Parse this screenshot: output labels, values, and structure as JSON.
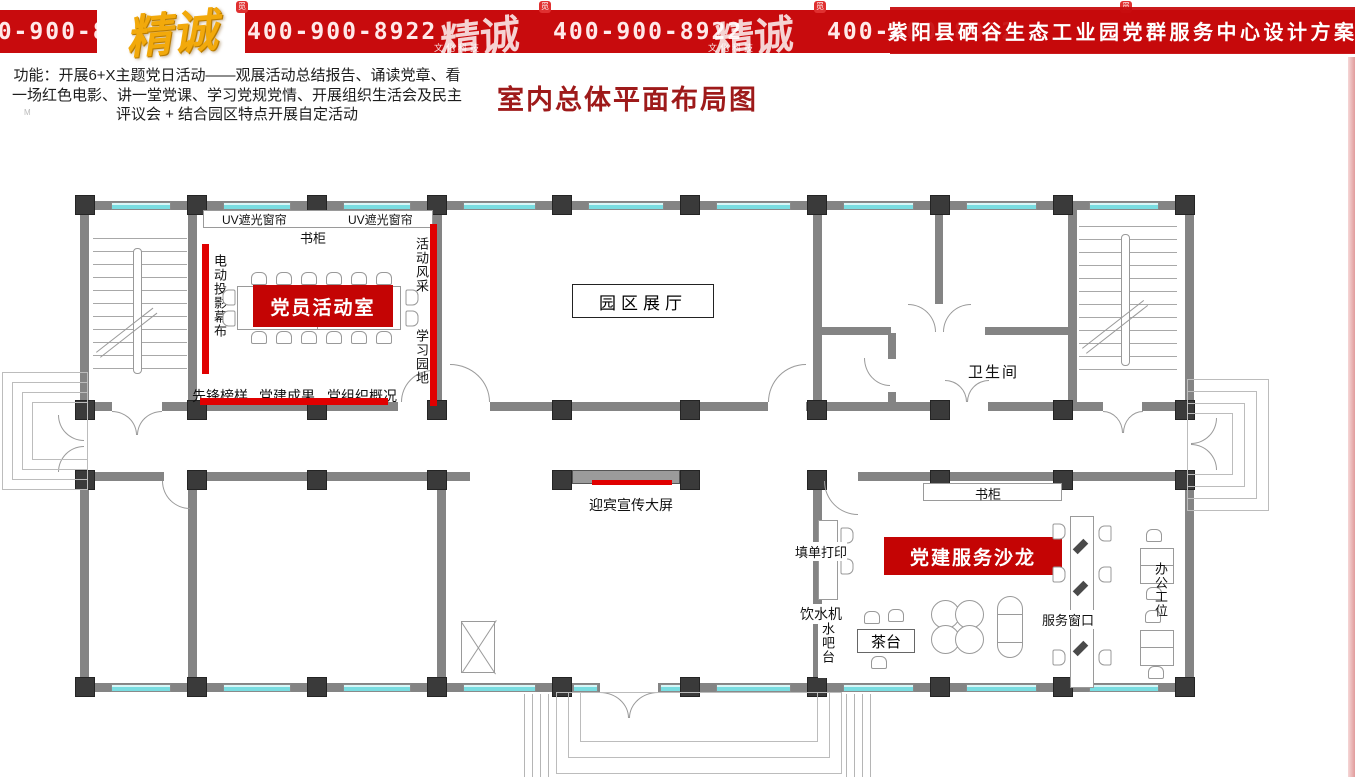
{
  "banner": {
    "phone": "400-900-8922",
    "brand": "精诚",
    "brand_sub": "文化科技",
    "badge": "觅",
    "title": "紫阳县硒谷生态工业园党群服务中心设计方案"
  },
  "intro": {
    "text": "功能：开展6+X主题党日活动——观展活动总结报告、诵读党章、看一场红色电影、讲一堂党课、学习党规党情、开展组织生活会及民主评议会 + 结合园区特点开展自定活动",
    "watermark": "M"
  },
  "page_title": "室内总体平面布局图",
  "plan": {
    "rooms": {
      "activity_room": "党员活动室",
      "exhibition_hall": "园区展厅",
      "restroom": "卫生间",
      "salon": "党建服务沙龙"
    },
    "labels": {
      "uv_curtain": "UV遮光窗帘",
      "bookcase": "书柜",
      "projector_screen": "电动投影幕布",
      "activity_display": "活动风采",
      "study_corner": "学习园地",
      "pioneer_models": "先锋榜样",
      "party_achievements": "党建成果",
      "party_org_overview": "党组织概况",
      "welcome_screen": "迎宾宣传大屏",
      "form_printing": "填单打印",
      "water_dispenser": "饮水机",
      "water_bar": "水吧台",
      "tea_table": "茶台",
      "service_window": "服务窗口",
      "office_workstations": "办公工位"
    },
    "colors": {
      "highlight_red": "#c40404",
      "banner_red": "#c80b0d",
      "title_red": "#9e1a1a",
      "wall_gray": "#848484",
      "column_dark": "#3a3a3a",
      "window_cyan": "#79dde1"
    }
  }
}
